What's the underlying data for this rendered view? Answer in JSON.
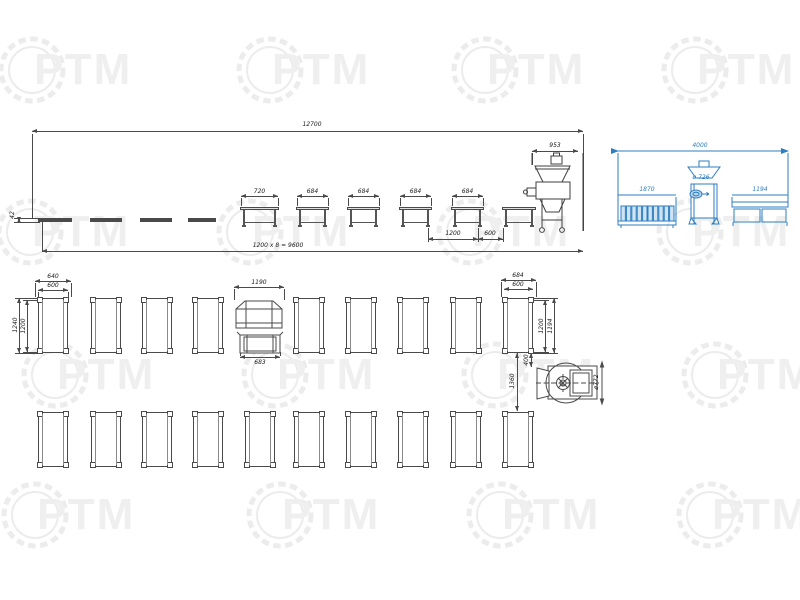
{
  "watermark": {
    "text": "РТМ"
  },
  "side_view": {
    "overall_length": "12700",
    "table_height": "42",
    "elevation_tables": [
      "720",
      "684",
      "684",
      "684",
      "684"
    ],
    "spacing": "1200",
    "end_spacing": "600",
    "chain_note": "1200 x 8 = 9600",
    "machine_width": "953"
  },
  "detail_view": {
    "overall_length": "4000",
    "left_table_length": "1870",
    "machine_diameter": "ø 726",
    "right_table_length": "1194"
  },
  "plan_view": {
    "row1_table_count": 9,
    "row2_table_count": 10,
    "left_table_outer_width": "640",
    "left_table_inner_width": "600",
    "left_table_outer_depth": "1240",
    "left_table_inner_depth": "1200",
    "conveyor_width": "1190",
    "conveyor_lower_width": "683",
    "right_table_outer_width": "684",
    "right_table_inner_width": "600",
    "right_table_depth": "1200",
    "right_table_inner_depth": "1194",
    "machine_offset": "400",
    "row_gap": "1360",
    "machine_diameter": "ø772"
  }
}
